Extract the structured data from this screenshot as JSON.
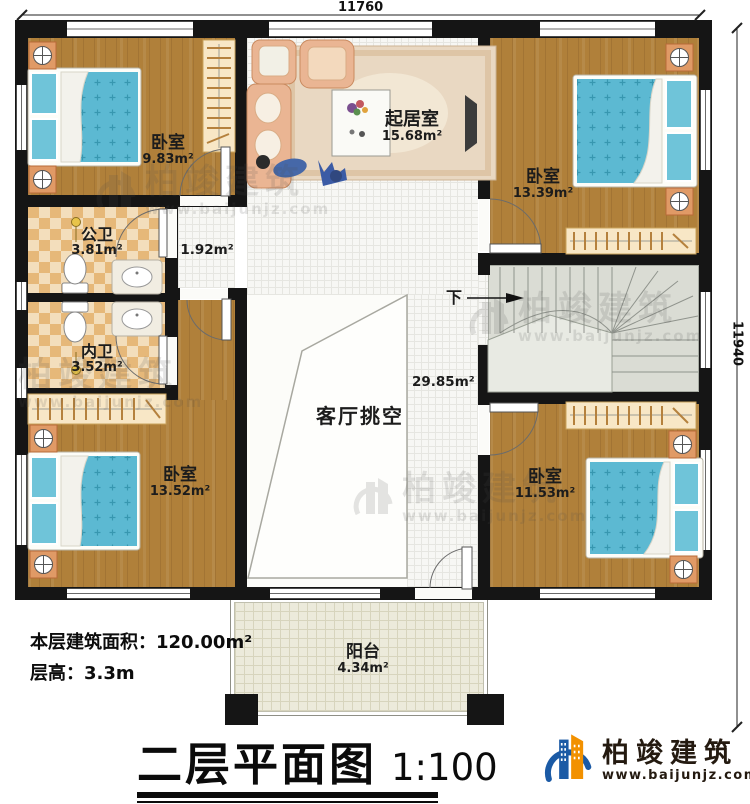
{
  "dimensions": {
    "top": "11760",
    "right": "11940"
  },
  "rooms": {
    "bedroom_tl": {
      "label": "卧室",
      "area": "9.83m²"
    },
    "living_room": {
      "label": "起居室",
      "area": "15.68m²"
    },
    "bedroom_tr": {
      "label": "卧室",
      "area": "13.39m²"
    },
    "public_bath": {
      "label": "公卫",
      "area": "3.81m²"
    },
    "hallway": {
      "area": "1.92m²"
    },
    "private_bath": {
      "label": "内卫",
      "area": "3.52m²"
    },
    "void": {
      "label": "客厅挑空",
      "area": "29.85m²"
    },
    "bedroom_bl": {
      "label": "卧室",
      "area": "13.52m²"
    },
    "bedroom_br": {
      "label": "卧室",
      "area": "11.53m²"
    },
    "balcony": {
      "label": "阳台",
      "area": "4.34m²"
    },
    "stairs": {
      "down": "下"
    }
  },
  "notes": {
    "floor_area": "本层建筑面积：120.00m²",
    "floor_height": "层高：3.3m"
  },
  "title": {
    "text": "二层平面图",
    "scale": "1:100"
  },
  "brand": {
    "name": "柏竣建筑",
    "url": "www.baijunjz.com"
  },
  "watermark": {
    "name": "柏竣建筑",
    "url": "www.baijunjz.com"
  },
  "colors": {
    "wall": "#151515",
    "wood": "#b0803a",
    "checker": "#e6b879",
    "mattress": "#5cb9d2",
    "stairs": "#dadcd4",
    "balcony": "#eceadb",
    "logo_blue": "#1b5aa5",
    "logo_orange": "#f29100",
    "logo_text": "#241a10"
  }
}
